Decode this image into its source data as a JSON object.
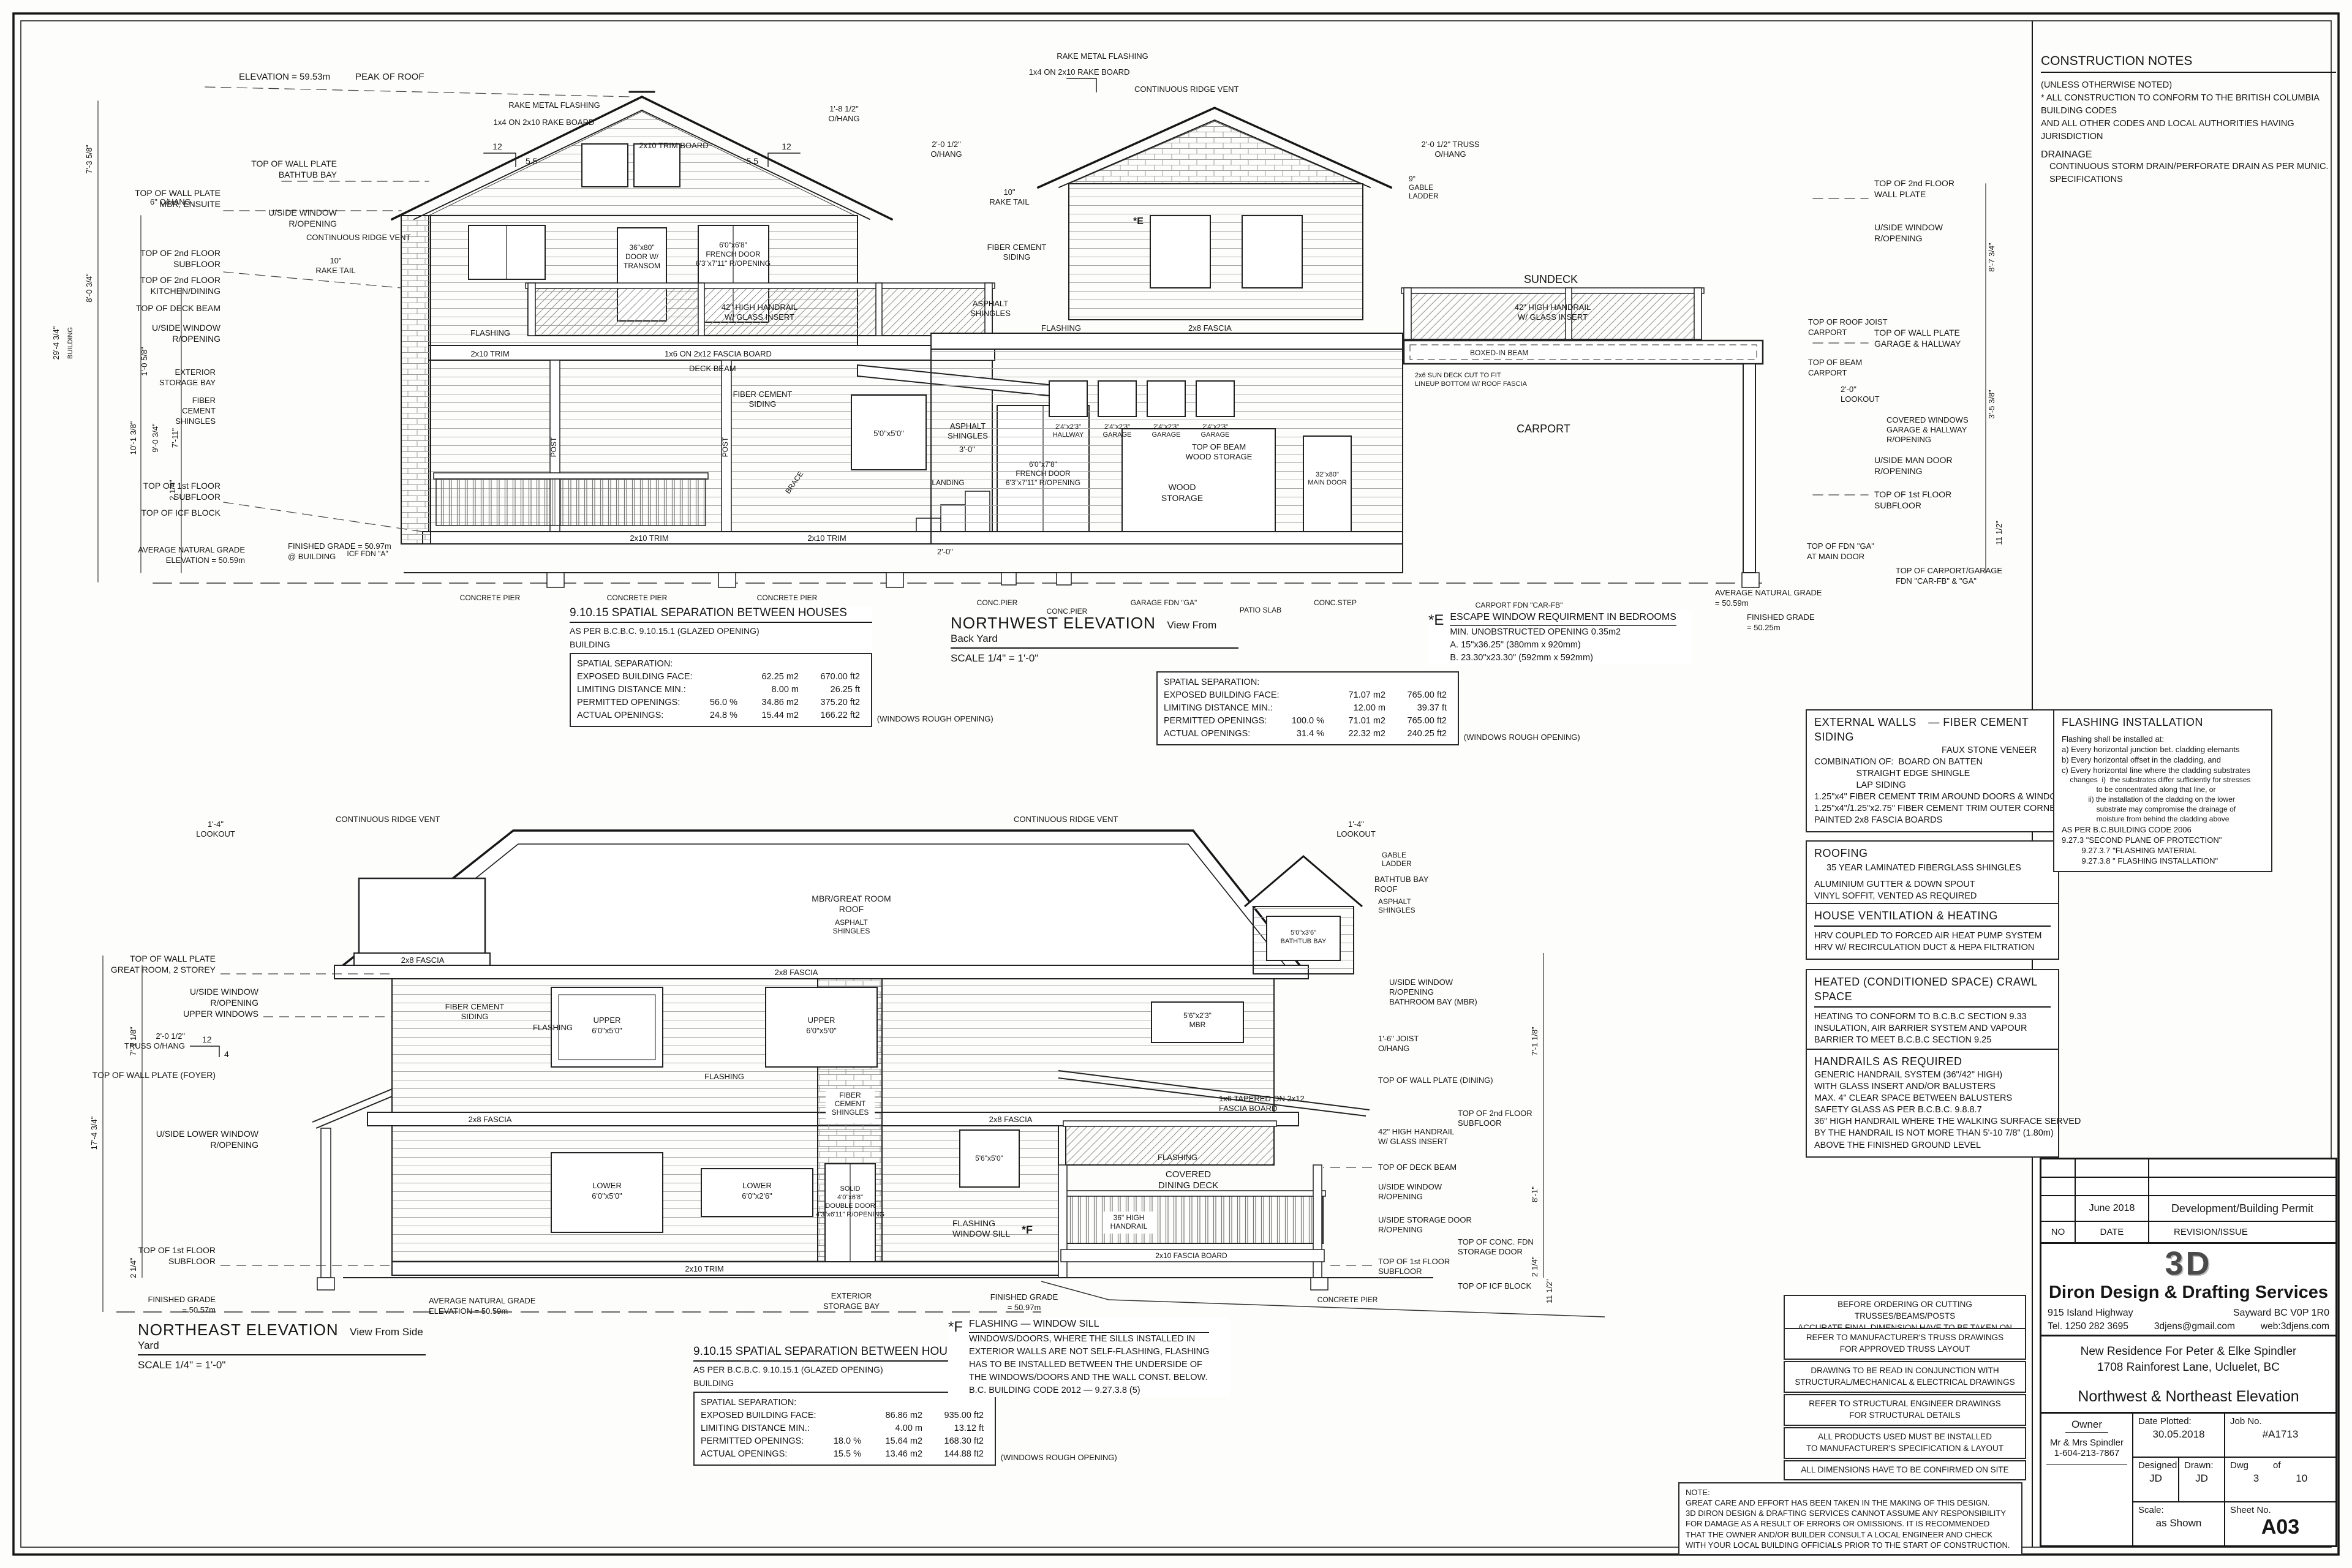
{
  "construction_notes": {
    "title": "CONSTRUCTION NOTES",
    "lines": [
      "(UNLESS OTHERWISE NOTED)",
      "* ALL CONSTRUCTION TO CONFORM TO THE BRITISH COLUMBIA BUILDING CODES",
      "  AND ALL OTHER CODES AND LOCAL AUTHORITIES HAVING JURISDICTION"
    ],
    "subhead": "DRAINAGE",
    "drainage": "CONTINUOUS STORM DRAIN/PERFORATE DRAIN AS PER MUNIC. SPECIFICATIONS"
  },
  "spec_boxes": {
    "external_walls": {
      "title": "EXTERNAL WALLS",
      "title2": "— FIBER CEMENT SIDING",
      "title3": "FAUX STONE VENEER",
      "lines": [
        "COMBINATION OF:  BOARD ON BATTEN",
        "                 STRAIGHT EDGE SHINGLE",
        "                 LAP SIDING",
        "",
        "1.25\"x4\" FIBER CEMENT TRIM AROUND DOORS & WINDOWS",
        "1.25\"x4\"/1.25\"x2.75\" FIBER CEMENT TRIM OUTER CORNERS",
        "",
        "PAINTED 2x8 FASCIA BOARDS"
      ]
    },
    "roofing": {
      "title": "ROOFING",
      "lead": "35 YEAR LAMINATED FIBERGLASS SHINGLES",
      "lines": [
        "ALUMINIUM GUTTER & DOWN SPOUT",
        "VINYL SOFFIT, VENTED AS REQUIRED"
      ]
    },
    "ventilation": {
      "title": "HOUSE VENTILATION & HEATING",
      "lines": [
        "HRV COUPLED TO FORCED AIR HEAT PUMP SYSTEM",
        "HRV W/ RECIRCULATION DUCT & HEPA FILTRATION"
      ]
    },
    "crawl": {
      "title": "HEATED (CONDITIONED SPACE)   CRAWL SPACE",
      "lines": [
        "HEATING TO CONFORM TO B.C.B.C SECTION 9.33",
        "INSULATION, AIR BARRIER SYSTEM AND VAPOUR",
        "BARRIER TO MEET B.C.B.C SECTION 9.25"
      ]
    },
    "handrails": {
      "title": "HANDRAILS AS REQUIRED",
      "lines": [
        "GENERIC HANDRAIL SYSTEM (36\"/42\" HIGH)",
        "WITH GLASS INSERT AND/OR BALUSTERS",
        "",
        "MAX. 4\" CLEAR SPACE BETWEEN BALUSTERS",
        "SAFETY GLASS AS PER B.C.B.C. 9.8.8.7",
        "36\" HIGH HANDRAIL WHERE THE WALKING SURFACE SERVED",
        "BY THE HANDRAIL IS NOT MORE THAN 5'-10 7/8\" (1.80m)",
        "ABOVE THE FINISHED GROUND LEVEL"
      ]
    },
    "flashing_install": {
      "title": "FLASHING INSTALLATION",
      "lines": [
        "Flashing shall be installed at:",
        "a) Every horizontal junction bet. cladding elemants",
        "b) Every horizontal offset in the cladding, and",
        "c) Every horizontal line where the cladding substrates",
        "    changes  i)  the substrates differ sufficiently for stresses",
        "                 to be concentrated along that line, or",
        "             ii) the installation of the cladding on the lower",
        "                 substrate may compromise the drainage of",
        "                 moisture from behind the cladding above",
        "",
        "AS PER B.C.BUILDING CODE 2006",
        "9.27.3 \"SECOND PLANE OF PROTECTION\"",
        "         9.27.3.7 \"FLASHING MATERIAL",
        "         9.27.3.8 \" FLASHING INSTALLATION\""
      ]
    }
  },
  "general_notes": {
    "items": [
      [
        "BEFORE ORDERING OR CUTTING TRUSSES/BEAMS/POSTS",
        "ACCURATE FINAL DIMENSION HAVE TO BE TAKEN ON SITE"
      ],
      [
        "REFER TO MANUFACTURER'S TRUSS DRAWINGS",
        "FOR APPROVED TRUSS LAYOUT"
      ],
      [
        "DRAWING TO BE READ IN CONJUNCTION WITH",
        "STRUCTURAL/MECHANICAL & ELECTRICAL DRAWINGS"
      ],
      [
        "REFER TO STRUCTURAL ENGINEER DRAWINGS",
        "FOR STRUCTURAL DETAILS"
      ],
      [
        "ALL PRODUCTS USED MUST BE INSTALLED",
        "TO MANUFACTURER'S SPECIFICATION & LAYOUT"
      ],
      [
        "ALL DIMENSIONS HAVE TO BE CONFIRMED ON SITE",
        ""
      ]
    ],
    "disclaimer": {
      "title": "NOTE:",
      "lines": [
        "GREAT CARE AND EFFORT HAS BEEN TAKEN IN THE MAKING OF THIS DESIGN.",
        "3D DIRON DESIGN & DRAFTING SERVICES CANNOT ASSUME ANY RESPONSIBILITY",
        "FOR DAMAGE AS A RESULT OF ERRORS OR OMISSIONS. IT IS RECOMMENDED",
        "THAT THE OWNER AND/OR BUILDER CONSULT A LOCAL ENGINEER AND CHECK",
        "WITH YOUR LOCAL BUILDING OFFICIALS PRIOR TO THE START OF CONSTRUCTION."
      ]
    }
  },
  "tables": {
    "header": "9.10.15 SPATIAL SEPARATION BETWEEN HOUSES",
    "sub": "AS PER B.C.B.C. 9.10.15.1 (GLAZED OPENING)",
    "building": "BUILDING",
    "note": "(WINDOWS ROUGH OPENING)",
    "nw": {
      "rows": [
        [
          "SPATIAL SEPARATION:",
          "",
          "",
          ""
        ],
        [
          "EXPOSED BUILDING FACE:",
          "",
          "62.25 m2",
          "670.00 ft2"
        ],
        [
          "LIMITING DISTANCE MIN.:",
          "",
          "8.00 m",
          "26.25 ft"
        ],
        [
          "PERMITTED OPENINGS:",
          "56.0 %",
          "34.86 m2",
          "375.20 ft2"
        ],
        [
          "ACTUAL OPENINGS:",
          "24.8 %",
          "15.44 m2",
          "166.22 ft2"
        ]
      ]
    },
    "mid": {
      "rows": [
        [
          "SPATIAL SEPARATION:",
          "",
          "",
          ""
        ],
        [
          "EXPOSED BUILDING FACE:",
          "",
          "71.07 m2",
          "765.00 ft2"
        ],
        [
          "LIMITING DISTANCE MIN.:",
          "",
          "12.00 m",
          "39.37 ft"
        ],
        [
          "PERMITTED OPENINGS:",
          "100.0 %",
          "71.01 m2",
          "765.00 ft2"
        ],
        [
          "ACTUAL OPENINGS:",
          "31.4 %",
          "22.32 m2",
          "240.25 ft2"
        ]
      ]
    },
    "ne": {
      "rows": [
        [
          "SPATIAL SEPARATION:",
          "",
          "",
          ""
        ],
        [
          "EXPOSED BUILDING FACE:",
          "",
          "86.86 m2",
          "935.00 ft2"
        ],
        [
          "LIMITING DISTANCE MIN.:",
          "",
          "4.00 m",
          "13.12 ft"
        ],
        [
          "PERMITTED OPENINGS:",
          "18.0 %",
          "15.64 m2",
          "168.30 ft2"
        ],
        [
          "ACTUAL OPENINGS:",
          "15.5 %",
          "13.46 m2",
          "144.88 ft2"
        ]
      ]
    }
  },
  "annotations": {
    "escape": {
      "mark": "*E",
      "title": "ESCAPE WINDOW REQUIRMENT IN BEDROOMS",
      "lines": [
        "MIN. UNOBSTRUCTED OPENING 0.35m2",
        "A. 15\"x36.25\" (380mm x 920mm)",
        "B. 23.30\"x23.30\" (592mm x 592mm)"
      ]
    },
    "flashing_f": {
      "mark": "*F",
      "title": "FLASHING — WINDOW SILL",
      "lines": [
        "WINDOWS/DOORS, WHERE THE SILLS INSTALLED IN",
        "EXTERIOR WALLS ARE NOT SELF-FLASHING, FLASHING",
        "HAS TO BE INSTALLED BETWEEN THE UNDERSIDE OF",
        "THE WINDOWS/DOORS AND THE WALL CONST. BELOW.",
        "B.C. BUILDING CODE 2012 —  9.27.3.8 (5)"
      ]
    }
  },
  "titleblock": {
    "revision": {
      "date": "June 2018",
      "desc": "Development/Building Permit",
      "col_no": "NO",
      "col_date": "DATE",
      "col_rev": "REVISION/ISSUE"
    },
    "company": {
      "logo": "3D",
      "name": "Diron Design & Drafting Services",
      "addr1": "915 Island Highway",
      "addr2": "Sayward BC   V0P 1R0",
      "tel": "Tel.  1250 282 3695",
      "email": "3djens@gmail.com",
      "web": "web:3djens.com"
    },
    "project": {
      "line1": "New Residence For Peter & Elke Spindler",
      "line2": "1708 Rainforest Lane, Ucluelet, BC",
      "sheet_title": "Northwest & Northeast Elevation"
    },
    "info": {
      "owner_label": "Owner",
      "owner_name": "Mr & Mrs Spindler",
      "owner_phone": "1-604-213-7867",
      "date_label": "Date Plotted:",
      "date": "30.05.2018",
      "job_label": "Job No.",
      "job": "#A1713",
      "designed_label": "Designed",
      "designed": "JD",
      "drawn_label": "Drawn:",
      "drawn": "JD",
      "dwg_label": "Dwg",
      "of_label": "of",
      "dwg_no": "3",
      "dwg_total": "10",
      "scale_label": "Scale:",
      "scale": "as Shown",
      "sheet_label": "Sheet No.",
      "sheet": "A03"
    }
  },
  "nw": {
    "title": "NORTHWEST ELEVATION",
    "subtitle": "View From Back Yard",
    "scale": "SCALE 1/4\" = 1'-0\"",
    "labels": {
      "elev_peak": "ELEVATION = 59.53m",
      "peak_of_roof": "PEAK OF ROOF",
      "rake_metal": "RAKE METAL FLASHING",
      "rake_board": "1x4 ON 2x10 RAKE BOARD",
      "slope_rise": "12",
      "slope_run": "5.5",
      "oh_18": [
        "1'-8 1/2\"",
        "O/HANG"
      ],
      "oh_20": [
        "2'-0 1/2\"",
        "O/HANG"
      ],
      "truss_oh": [
        "2'-0 1/2\" TRUSS",
        "O/HANG"
      ],
      "ridge_vent": "CONTINUOUS RIDGE VENT",
      "rake_tail": [
        "10\"",
        "RAKE TAIL"
      ],
      "oh6": "6\" O/HANG",
      "twp_bathtub": [
        "TOP OF WALL PLATE",
        "BATHTUB BAY"
      ],
      "twp_mbr": [
        "TOP OF WALL PLATE",
        "MBR, ENSUITE"
      ],
      "uside_win": [
        "U/SIDE WINDOW",
        "R/OPENING"
      ],
      "t2f_sub": [
        "TOP OF 2nd FLOOR",
        "SUBFLOOR"
      ],
      "t2f_kitchen": [
        "TOP OF 2nd FLOOR",
        "KITCHEN/DINING"
      ],
      "top_deck_beam": "TOP OF DECK BEAM",
      "exterior_storage": [
        "EXTERIOR",
        "STORAGE BAY"
      ],
      "fiber_shingles": [
        "FIBER",
        "CEMENT",
        "SHINGLES"
      ],
      "t1f_sub": [
        "TOP OF 1st FLOOR",
        "SUBFLOOR"
      ],
      "top_icf": "TOP OF ICF BLOCK",
      "avg_grade": [
        "AVERAGE NATURAL GRADE",
        "ELEVATION = 50.59m"
      ],
      "fin_grade": [
        "FINISHED GRADE = 50.97m",
        "@ BUILDING"
      ],
      "door_transom": [
        "36\"x80\"",
        "DOOR W/",
        "TRANSOM"
      ],
      "fr_door_up": [
        "6'0\"x6'8\"",
        "FRENCH DOOR",
        "6'3\"x7'11\" R/OPENING"
      ],
      "handrail42": [
        "42\" HIGH HANDRAIL",
        "W/ GLASS INSERT"
      ],
      "win55": "5'0\"x5'0\"",
      "fr_door_low": [
        "6'0\"x7'8\"",
        "FRENCH DOOR",
        "6'3\"x7'11\" R/OPENING"
      ],
      "post": "POST",
      "brace": "BRACE",
      "dim30": "3'-0\"",
      "dim20": "2'-0\"",
      "landing": "LANDING",
      "trim_board": "2x10 TRIM BOARD",
      "trim": "2x10 TRIM",
      "flashing": "FLASHING",
      "fascia28": "2x8 FASCIA",
      "fascia_band": "1x6 ON 2x12 FASCIA BOARD",
      "deck_beam": "DECK BEAM",
      "asphalt": [
        "ASPHALT",
        "SHINGLES"
      ],
      "fc_siding": [
        "FIBER CEMENT",
        "SIDING"
      ],
      "icf_fdn": "ICF FDN \"A\"",
      "w_hall": [
        "2'4\"x2'3\"",
        "HALLWAY"
      ],
      "w_gar": [
        "2'4\"x2'3\"",
        "GARAGE"
      ],
      "wood_storage": [
        "WOOD",
        "STORAGE"
      ],
      "main_door": [
        "32\"x80\"",
        "MAIN DOOR"
      ],
      "gable_ladder": [
        "9\"",
        "GABLE",
        "LADDER"
      ],
      "top_beam_ws": [
        "TOP OF BEAM",
        "WOOD STORAGE"
      ],
      "sundeck": "SUNDECK",
      "boxed_beam": "BOXED-IN BEAM",
      "sun_deck_note": [
        "2x6 SUN DECK CUT TO FIT",
        "LINEUP BOTTOM W/ ROOF FASCIA"
      ],
      "carport": "CARPORT",
      "conc_pier": "CONCRETE PIER",
      "conc_pier_s": "CONC.PIER",
      "garage_fdn": "GARAGE FDN \"GA\"",
      "patio": "PATIO SLAB",
      "conc_step": "CONC.STEP",
      "carport_fdn": "CARPORT FDN \"CAR-FB\"",
      "r_t2f_wp": [
        "TOP OF 2nd FLOOR",
        "WALL PLATE"
      ],
      "r_roof_joist": [
        "TOP OF ROOF JOIST",
        "CARPORT"
      ],
      "r_beam_carport": [
        "TOP OF BEAM",
        "CARPORT"
      ],
      "r_wp_garage": [
        "TOP OF WALL PLATE",
        "GARAGE & HALLWAY"
      ],
      "lookout20": [
        "2'-0\"",
        "LOOKOUT"
      ],
      "covered_windows": [
        "COVERED WINDOWS",
        "GARAGE & HALLWAY",
        "R/OPENING"
      ],
      "uside_man": [
        "U/SIDE MAN DOOR",
        "R/OPENING"
      ],
      "fdn_ga": [
        "TOP OF FDN \"GA\"",
        "AT MAIN DOOR"
      ],
      "carport_fdn2": [
        "TOP OF CARPORT/GARAGE",
        "FDN \"CAR-FB\" & \"GA\""
      ],
      "r_avg": [
        "AVERAGE NATURAL GRADE",
        "= 50.59m"
      ],
      "r_fin": [
        "FINISHED GRADE",
        "= 50.25m"
      ],
      "mark_e": "*E",
      "d29": "29'-4 3/4\"",
      "d_bldg": "BUILDING",
      "d735": "7'-3 5/8\"",
      "d803": "8'-0 3/4\"",
      "d1013": "10'-1 3/8\"",
      "d903": "9'-0 3/4\"",
      "d711": "7'-11\"",
      "d214": "2 1/4\"",
      "d105": "1'-0 5/8\"",
      "d877": "8'-7 3/4\"",
      "d1112": "11 1/2\"",
      "d353": "3'-5 3/8\""
    }
  },
  "ne": {
    "title": "NORTHEAST ELEVATION",
    "subtitle": "View From Side Yard",
    "scale": "SCALE 1/4\" = 1'-0\"",
    "labels": {
      "lookout14": [
        "1'-4\"",
        "LOOKOUT"
      ],
      "ridge_vent": "CONTINUOUS RIDGE VENT",
      "gable_ladder": [
        "GABLE",
        "LADDER"
      ],
      "roof_main": [
        "MBR/GREAT ROOM",
        "ROOF"
      ],
      "asphalt": [
        "ASPHALT",
        "SHINGLES"
      ],
      "bathtub_roof": [
        "BATHTUB BAY",
        "ROOF"
      ],
      "fascia28": "2x8 FASCIA",
      "twp_great": [
        "TOP OF WALL PLATE",
        "GREAT ROOM, 2 STOREY"
      ],
      "uside_upper": [
        "U/SIDE WINDOW",
        "R/OPENING",
        "UPPER WINDOWS"
      ],
      "truss_oh": [
        "2'-0 1/2\"",
        "TRUSS O/HANG"
      ],
      "slope_rise": "12",
      "slope_run": "4",
      "flashing": "FLASHING",
      "twp_foyer": "TOP OF WALL PLATE (FOYER)",
      "uside_lower": [
        "U/SIDE LOWER WINDOW",
        "R/OPENING"
      ],
      "t1f_sub": [
        "TOP OF 1st FLOOR",
        "SUBFLOOR"
      ],
      "fin_grade_l": [
        "FINISHED GRADE",
        "= 50.57m"
      ],
      "fin_grade_r": [
        "FINISHED GRADE",
        "= 50.97m"
      ],
      "avg_grade": [
        "AVERAGE NATURAL GRADE",
        "ELEVATION = 50.59m"
      ],
      "upper_win": [
        "UPPER",
        "6'0\"x5'0\""
      ],
      "mbr_win": [
        "5'6\"x2'3\"",
        "MBR"
      ],
      "fc_siding": [
        "FIBER CEMENT",
        "SIDING"
      ],
      "fc_shingles": [
        "FIBER",
        "CEMENT",
        "SHINGLES"
      ],
      "lower_win": [
        "LOWER",
        "6'0\"x5'0\""
      ],
      "lower_win2": [
        "LOWER",
        "6'0\"x2'6\""
      ],
      "win5650": "5'6\"x5'0\"",
      "dbl_door": [
        "SOLID",
        "4'0\"x6'8\"",
        "DOUBLE DOOR",
        "4'3\"x6'11\" R/OPENING"
      ],
      "flashing_sill": [
        "FLASHING",
        "WINDOW SILL"
      ],
      "mark_f": "*F",
      "trim210": "2x10 TRIM",
      "fascia210": "2x10 FASCIA BOARD",
      "storage_bay": [
        "EXTERIOR",
        "STORAGE BAY"
      ],
      "bathtub_win": [
        "5'0\"x3'6\"",
        "BATHTUB BAY"
      ],
      "handrail42": [
        "42\" HIGH HANDRAIL",
        "W/ GLASS INSERT"
      ],
      "tapered": [
        "1x6 TAPERED ON 2x12",
        "FASCIA BOARD"
      ],
      "covered": [
        "COVERED",
        "DINING DECK"
      ],
      "handrail36": [
        "36\" HIGH",
        "HANDRAIL"
      ],
      "uside_storage": [
        "U/SIDE STORAGE DOOR",
        "R/OPENING"
      ],
      "top_deck_beam": "TOP OF DECK BEAM",
      "uside_win": [
        "U/SIDE WINDOW",
        "R/OPENING"
      ],
      "twp_dining": "TOP OF WALL PLATE (DINING)",
      "t2f_sub": [
        "TOP OF 2nd FLOOR",
        "SUBFLOOR"
      ],
      "top_icf": "TOP OF ICF BLOCK",
      "conc_fdn": [
        "TOP OF CONC. FDN",
        "STORAGE DOOR"
      ],
      "joist_oh": [
        "1'-6\" JOIST",
        "O/HANG"
      ],
      "conc_pier": "CONCRETE PIER",
      "uside_bath": [
        "U/SIDE WINDOW",
        "R/OPENING",
        "BATHROOM BAY (MBR)"
      ],
      "d174": "17'-4 3/4\"",
      "d7118": "7'-1 1/8\"",
      "d214": "2 1/4\"",
      "d1112": "11 1/2\"",
      "d81": "8'-1\""
    }
  }
}
